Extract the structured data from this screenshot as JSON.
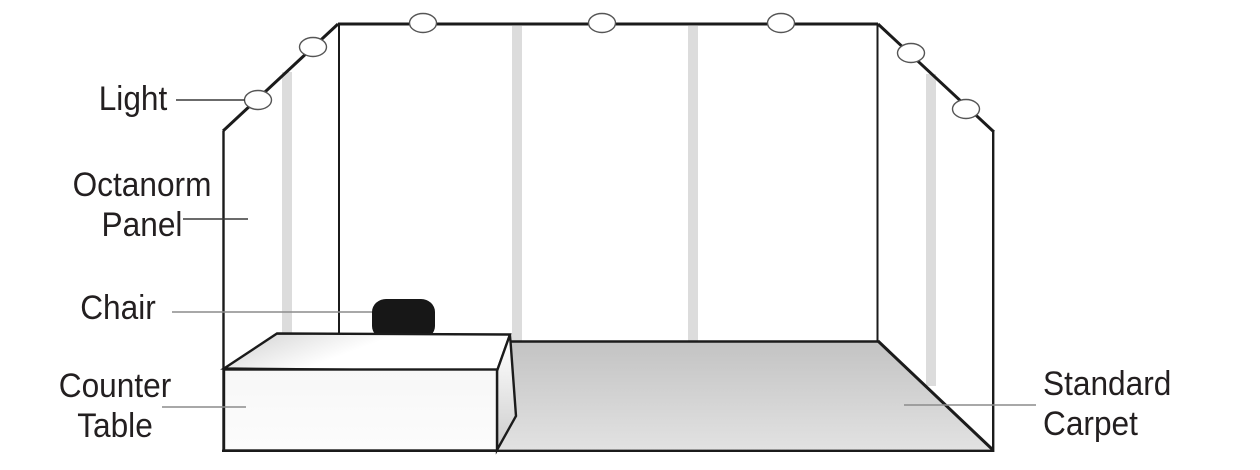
{
  "diagram": {
    "type": "exhibition-booth-setup-diagram",
    "labels": {
      "light": "Light",
      "octanorm_panel": {
        "line1": "Octanorm",
        "line2": "Panel"
      },
      "chair": "Chair",
      "counter_table": {
        "line1": "Counter",
        "line2": "Table"
      },
      "standard_carpet": {
        "line1": "Standard",
        "line2": "Carpet"
      }
    },
    "colors": {
      "background": "#ffffff",
      "ink": "#1b1b1b",
      "text": "#231f20",
      "leader_dark": "#3a3a3a",
      "leader_gray": "#8c8c8c",
      "panel_strip": "#dcdcdc",
      "oval_stroke": "#555555",
      "chair": "#171717",
      "carpet_top": "#c3c3c3",
      "carpet_bottom": "#e2e2e2",
      "table_top_dark": "#cfcfcf",
      "table_front": "#f7f7f7",
      "table_side_bottom": "#cccccc"
    }
  }
}
